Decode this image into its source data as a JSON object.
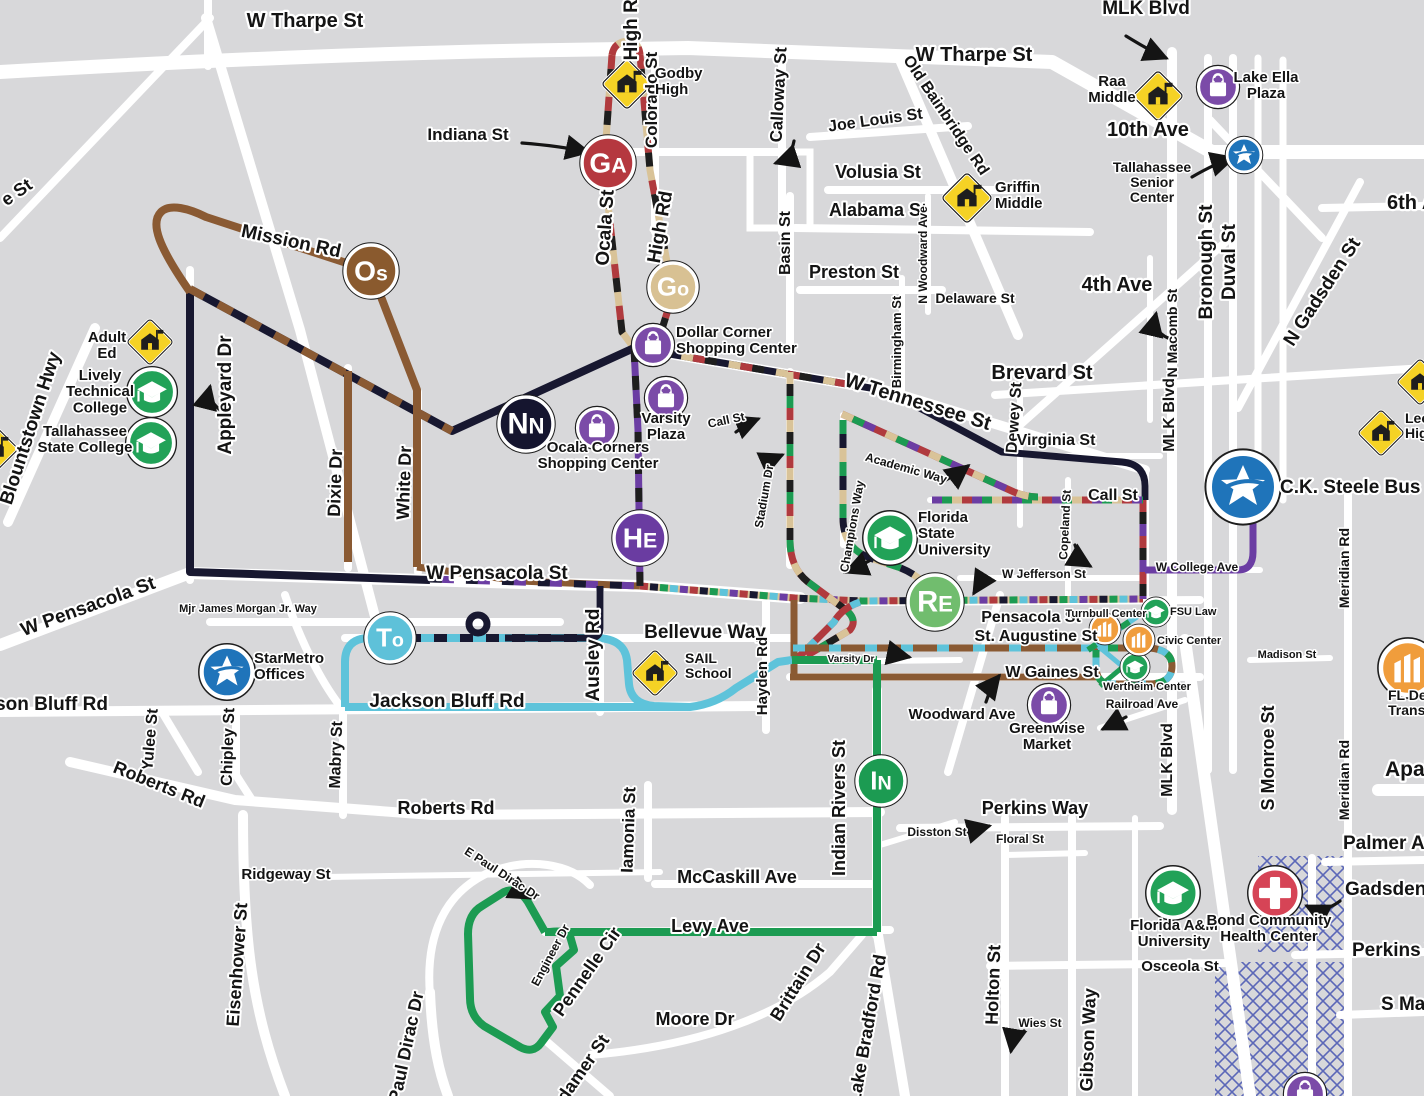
{
  "palette": {
    "background": "#d8d8da",
    "road": "#ffffff",
    "label": "#141414",
    "halo": "#ffffff",
    "ink": "#1e1e1e",
    "navy": "#181830",
    "brown": "#8a5a33",
    "tan": "#d9c398",
    "red": "#b03a3e",
    "purple": "#6b3da3",
    "cyan": "#5ec3da",
    "green": "#1c9b52",
    "light_green": "#72bd72",
    "marker_tan": "#d8c193",
    "school_yellow": "#f5d225",
    "poi_green": "#22a258",
    "poi_purple": "#7b4ba8",
    "poi_blue": "#1f74ba",
    "poi_orange": "#f09d3c",
    "poi_red": "#d64456",
    "hatch": "#5b67b8"
  },
  "route_markers": [
    {
      "id": "ga",
      "label": "GA",
      "x": 608,
      "y": 163,
      "r": 26,
      "color": "#b5383f"
    },
    {
      "id": "go",
      "label": "Go",
      "x": 673,
      "y": 287,
      "r": 24,
      "color": "#d8c193"
    },
    {
      "id": "os",
      "label": "Os",
      "x": 371,
      "y": 271,
      "r": 26,
      "color": "#8a5a2e"
    },
    {
      "id": "nn",
      "label": "NN",
      "x": 526,
      "y": 424,
      "r": 27,
      "color": "#15152f"
    },
    {
      "id": "he",
      "label": "HE",
      "x": 640,
      "y": 538,
      "r": 26,
      "color": "#6a3ca1"
    },
    {
      "id": "to",
      "label": "To",
      "x": 390,
      "y": 638,
      "r": 24,
      "color": "#5ec1d9"
    },
    {
      "id": "re",
      "label": "RE",
      "x": 935,
      "y": 602,
      "r": 27,
      "color": "#71bd6e"
    },
    {
      "id": "in",
      "label": "IN",
      "x": 881,
      "y": 781,
      "r": 24,
      "color": "#1c9b52"
    }
  ],
  "labels": [
    {
      "t": "W Tharpe St",
      "x": 305,
      "y": 27,
      "s": 20
    },
    {
      "t": "W Tharpe St",
      "x": 974,
      "y": 61,
      "s": 20
    },
    {
      "t": "MLK Blvd",
      "x": 1146,
      "y": 14,
      "s": 19
    },
    {
      "t": "High Rd",
      "x": 637,
      "y": 24,
      "r": -90,
      "s": 19
    },
    {
      "t": "Ocala St",
      "x": 611,
      "y": 228,
      "r": -86,
      "s": 19
    },
    {
      "t": "High Rd",
      "x": 666,
      "y": 228,
      "r": -80,
      "s": 19
    },
    {
      "t": "Indiana St",
      "x": 468,
      "y": 140,
      "s": 17
    },
    {
      "t": "Colorado St",
      "x": 657,
      "y": 100,
      "r": -90,
      "s": 17
    },
    {
      "t": "Calloway St",
      "x": 784,
      "y": 95,
      "r": -87,
      "s": 17
    },
    {
      "t": "Joe Louis St",
      "x": 876,
      "y": 125,
      "r": -8,
      "s": 16
    },
    {
      "t": "Old Bainbridge Rd",
      "x": 942,
      "y": 118,
      "r": 56,
      "s": 16
    },
    {
      "t": "Volusia St",
      "x": 878,
      "y": 178,
      "s": 18
    },
    {
      "t": "Alabama St",
      "x": 878,
      "y": 216,
      "s": 18
    },
    {
      "t": "Basin St",
      "x": 790,
      "y": 243,
      "r": -90,
      "s": 16
    },
    {
      "t": "Preston St",
      "x": 854,
      "y": 278,
      "s": 18
    },
    {
      "t": "Delaware St",
      "x": 975,
      "y": 303,
      "s": 14
    },
    {
      "t": "Birmingham St",
      "x": 901,
      "y": 342,
      "r": -90,
      "s": 13
    },
    {
      "t": "N Woodward Ave",
      "x": 927,
      "y": 255,
      "r": -90,
      "s": 12
    },
    {
      "t": "4th Ave",
      "x": 1117,
      "y": 291,
      "s": 20
    },
    {
      "t": "N Macomb St",
      "x": 1177,
      "y": 333,
      "r": -90,
      "s": 14
    },
    {
      "t": "Bronough St",
      "x": 1212,
      "y": 262,
      "r": -90,
      "s": 19
    },
    {
      "t": "Duval St",
      "x": 1235,
      "y": 262,
      "r": -90,
      "s": 19
    },
    {
      "t": "N Gadsden St",
      "x": 1327,
      "y": 295,
      "r": -57,
      "s": 19
    },
    {
      "t": "6th Ave",
      "x": 1387,
      "y": 209,
      "s": 20,
      "a": "start"
    },
    {
      "t": "10th Ave",
      "x": 1148,
      "y": 136,
      "s": 20
    },
    {
      "t": "e St",
      "x": 20,
      "y": 197,
      "r": -35,
      "s": 18
    },
    {
      "t": "Mission Rd",
      "x": 290,
      "y": 247,
      "r": 12,
      "s": 19
    },
    {
      "t": "Blountstown Hwy",
      "x": 36,
      "y": 430,
      "r": -72,
      "s": 19
    },
    {
      "t": "Appleyard Dr",
      "x": 231,
      "y": 395,
      "r": -90,
      "s": 19
    },
    {
      "t": "Dixie Dr",
      "x": 341,
      "y": 483,
      "r": -88,
      "s": 18
    },
    {
      "t": "White Dr",
      "x": 410,
      "y": 483,
      "r": -88,
      "s": 18
    },
    {
      "t": "W Tennessee St",
      "x": 916,
      "y": 408,
      "r": 17,
      "s": 20
    },
    {
      "t": "Call St",
      "x": 727,
      "y": 424,
      "r": -12,
      "s": 12
    },
    {
      "t": "Academic Way",
      "x": 905,
      "y": 472,
      "r": 16,
      "s": 12
    },
    {
      "t": "Call St",
      "x": 1113,
      "y": 500,
      "s": 16
    },
    {
      "t": "Brevard St",
      "x": 1042,
      "y": 379,
      "s": 20
    },
    {
      "t": "Dewey St",
      "x": 1019,
      "y": 418,
      "r": -86,
      "s": 16
    },
    {
      "t": "Virginia St",
      "x": 1056,
      "y": 445,
      "s": 16
    },
    {
      "t": "MLK Blvd",
      "x": 1174,
      "y": 415,
      "r": -90,
      "s": 16
    },
    {
      "t": "MLK Blvd",
      "x": 1172,
      "y": 760,
      "r": -90,
      "s": 16
    },
    {
      "t": "Copeland St",
      "x": 1069,
      "y": 525,
      "r": -87,
      "s": 12
    },
    {
      "t": "Champions Way",
      "x": 856,
      "y": 527,
      "r": -80,
      "s": 12
    },
    {
      "t": "Stadium Dr",
      "x": 768,
      "y": 497,
      "r": -80,
      "s": 12
    },
    {
      "t": "W Jefferson St",
      "x": 1002,
      "y": 578,
      "s": 12,
      "a": "start"
    },
    {
      "t": "W College Ave",
      "x": 1197,
      "y": 571,
      "s": 12
    },
    {
      "t": "Meridian Rd",
      "x": 1349,
      "y": 568,
      "r": -90,
      "s": 14
    },
    {
      "t": "Meridian Rd",
      "x": 1349,
      "y": 780,
      "r": -90,
      "s": 14
    },
    {
      "t": "Pensacola St",
      "x": 1031,
      "y": 622,
      "s": 16
    },
    {
      "t": "St. Augustine St",
      "x": 1036,
      "y": 641,
      "s": 16
    },
    {
      "t": "Madison St",
      "x": 1287,
      "y": 658,
      "s": 11
    },
    {
      "t": "W Gaines St",
      "x": 1052,
      "y": 677,
      "s": 16
    },
    {
      "t": "Railroad Ave",
      "x": 1142,
      "y": 708,
      "s": 12
    },
    {
      "t": "Varsity Dr",
      "x": 851,
      "y": 662,
      "s": 10
    },
    {
      "t": "Woodward Ave",
      "x": 962,
      "y": 719,
      "s": 15
    },
    {
      "t": "Mjr James Morgan Jr. Way",
      "x": 248,
      "y": 612,
      "s": 11
    },
    {
      "t": "W Pensacola St",
      "x": 90,
      "y": 612,
      "r": -20,
      "s": 19
    },
    {
      "t": "W Pensacola St",
      "x": 497,
      "y": 579,
      "s": 19
    },
    {
      "t": "Ausley Rd",
      "x": 599,
      "y": 655,
      "r": -90,
      "s": 19
    },
    {
      "t": "Bellevue Way",
      "x": 705,
      "y": 638,
      "s": 19
    },
    {
      "t": "Hayden Rd",
      "x": 767,
      "y": 676,
      "r": -90,
      "s": 15
    },
    {
      "t": "Jackson Bluff Rd",
      "x": 447,
      "y": 707,
      "s": 19
    },
    {
      "t": "Jackson Bluff Rd",
      "x": 108,
      "y": 710,
      "s": 19,
      "a": "end"
    },
    {
      "t": "Yulee St",
      "x": 155,
      "y": 740,
      "r": -85,
      "s": 16
    },
    {
      "t": "Chipley St",
      "x": 233,
      "y": 747,
      "r": -88,
      "s": 16
    },
    {
      "t": "Mabry St",
      "x": 341,
      "y": 755,
      "r": -88,
      "s": 16
    },
    {
      "t": "Roberts Rd",
      "x": 157,
      "y": 790,
      "r": 22,
      "s": 18
    },
    {
      "t": "Roberts Rd",
      "x": 446,
      "y": 814,
      "s": 18
    },
    {
      "t": "Ridgeway St",
      "x": 286,
      "y": 879,
      "s": 15
    },
    {
      "t": "Eisenhower St",
      "x": 243,
      "y": 965,
      "r": -86,
      "s": 18
    },
    {
      "t": "Paul Dirac Dr",
      "x": 412,
      "y": 1048,
      "r": -78,
      "s": 18
    },
    {
      "t": "E Paul Dirac Dr",
      "x": 500,
      "y": 877,
      "r": 33,
      "s": 12
    },
    {
      "t": "Engineer Dr",
      "x": 554,
      "y": 957,
      "r": -62,
      "s": 12
    },
    {
      "t": "Pennelle Cir",
      "x": 592,
      "y": 975,
      "r": -55,
      "s": 18
    },
    {
      "t": "Iamonia St",
      "x": 634,
      "y": 830,
      "r": -88,
      "s": 17
    },
    {
      "t": "McCaskill Ave",
      "x": 737,
      "y": 883,
      "s": 18
    },
    {
      "t": "Levy Ave",
      "x": 710,
      "y": 932,
      "s": 18
    },
    {
      "t": "Moore Dr",
      "x": 695,
      "y": 1025,
      "s": 18
    },
    {
      "t": "Brittain Dr",
      "x": 803,
      "y": 985,
      "r": -58,
      "s": 18
    },
    {
      "t": "Lake Bradford Rd",
      "x": 873,
      "y": 1030,
      "r": -80,
      "s": 18
    },
    {
      "t": "Pottsdamer St",
      "x": 575,
      "y": 1090,
      "r": -55,
      "s": 18
    },
    {
      "t": "Indian Rivers St",
      "x": 845,
      "y": 808,
      "r": -90,
      "s": 18
    },
    {
      "t": "Perkins Way",
      "x": 1035,
      "y": 814,
      "s": 18
    },
    {
      "t": "Disston St",
      "x": 937,
      "y": 836,
      "s": 12
    },
    {
      "t": "Floral St",
      "x": 1020,
      "y": 843,
      "s": 12
    },
    {
      "t": "Holton St",
      "x": 999,
      "y": 985,
      "r": -88,
      "s": 18
    },
    {
      "t": "Wies St",
      "x": 1040,
      "y": 1027,
      "s": 12
    },
    {
      "t": "Gibson Way",
      "x": 1094,
      "y": 1040,
      "r": -88,
      "s": 18
    },
    {
      "t": "Osceola St",
      "x": 1180,
      "y": 971,
      "s": 15
    },
    {
      "t": "S Monroe St",
      "x": 1274,
      "y": 758,
      "r": -90,
      "s": 18
    },
    {
      "t": "Palmer Ave",
      "x": 1343,
      "y": 849,
      "s": 19,
      "a": "start"
    },
    {
      "t": "Gadsden St",
      "x": 1345,
      "y": 895,
      "s": 19,
      "a": "start"
    },
    {
      "t": "Perkins Way",
      "x": 1352,
      "y": 956,
      "s": 19,
      "a": "start"
    },
    {
      "t": "S Magnolia Dr",
      "x": 1381,
      "y": 1010,
      "s": 19,
      "a": "start"
    },
    {
      "t": "Apalachee Pkwy",
      "x": 1385,
      "y": 776,
      "s": 21,
      "a": "start"
    },
    {
      "n": "poi-label",
      "t": "Godby High",
      "x": 655,
      "y": 78,
      "s": 15,
      "a": "start",
      "lines": [
        "Godby",
        "High"
      ]
    },
    {
      "n": "poi-label",
      "t": "Raa Middle",
      "x": 1112,
      "y": 86,
      "s": 15,
      "lines": [
        "Raa",
        "Middle"
      ]
    },
    {
      "n": "poi-label",
      "t": "Lake Ella Plaza",
      "x": 1266,
      "y": 82,
      "s": 15,
      "lines": [
        "Lake Ella",
        "Plaza"
      ]
    },
    {
      "n": "poi-label",
      "t": "Griffin Middle",
      "x": 995,
      "y": 192,
      "s": 15,
      "a": "start",
      "lines": [
        "Griffin",
        "Middle"
      ]
    },
    {
      "n": "poi-label",
      "t": "Tallahassee Senior Center",
      "x": 1152,
      "y": 172,
      "s": 14,
      "lines": [
        "Tallahassee",
        "Senior",
        "Center"
      ]
    },
    {
      "n": "poi-label",
      "t": "Adult Ed",
      "x": 107,
      "y": 342,
      "s": 15,
      "lines": [
        "Adult",
        "Ed"
      ]
    },
    {
      "n": "poi-label",
      "t": "Lively Technical College",
      "x": 100,
      "y": 380,
      "s": 15,
      "lines": [
        "Lively",
        "Technical",
        "College"
      ]
    },
    {
      "n": "poi-label",
      "t": "Tallahassee State College",
      "x": 85,
      "y": 436,
      "s": 15,
      "lines": [
        "Tallahassee",
        "State College"
      ]
    },
    {
      "n": "poi-label",
      "t": "Dollar Corner Shopping Center",
      "x": 676,
      "y": 337,
      "s": 15,
      "a": "start",
      "lines": [
        "Dollar Corner",
        "Shopping Center"
      ]
    },
    {
      "n": "poi-label",
      "t": "Varsity Plaza",
      "x": 666,
      "y": 423,
      "s": 15,
      "lines": [
        "Varsity",
        "Plaza"
      ]
    },
    {
      "n": "poi-label",
      "t": "Ocala Corners Shopping Center",
      "x": 598,
      "y": 452,
      "s": 15,
      "lines": [
        "Ocala Corners",
        "Shopping Center"
      ]
    },
    {
      "n": "poi-label",
      "t": "Florida State University",
      "x": 918,
      "y": 522,
      "s": 15,
      "a": "start",
      "lines": [
        "Florida",
        "State",
        "University"
      ]
    },
    {
      "n": "poi-label",
      "t": "C.K. Steele Bus Plaza",
      "x": 1280,
      "y": 493,
      "s": 19,
      "a": "start"
    },
    {
      "n": "poi-label",
      "t": "Leon High",
      "x": 1405,
      "y": 423,
      "s": 14,
      "a": "start",
      "lines": [
        "Leon",
        "High"
      ]
    },
    {
      "n": "poi-label",
      "t": "Turnbull Center",
      "x": 1106,
      "y": 617,
      "s": 11
    },
    {
      "n": "poi-label",
      "t": "FSU Law",
      "x": 1170,
      "y": 615,
      "s": 11,
      "a": "start"
    },
    {
      "n": "poi-label",
      "t": "Civic Center",
      "x": 1157,
      "y": 644,
      "s": 11,
      "a": "start"
    },
    {
      "n": "poi-label",
      "t": "Wertheim Center",
      "x": 1147,
      "y": 690,
      "s": 11
    },
    {
      "n": "poi-label",
      "t": "StarMetro Offices",
      "x": 254,
      "y": 663,
      "s": 15,
      "a": "start",
      "lines": [
        "StarMetro",
        "Offices"
      ]
    },
    {
      "n": "poi-label",
      "t": "SAIL School",
      "x": 685,
      "y": 663,
      "s": 14,
      "a": "start",
      "lines": [
        "SAIL",
        "School"
      ]
    },
    {
      "n": "poi-label",
      "t": "Greenwise Market",
      "x": 1047,
      "y": 733,
      "s": 15,
      "lines": [
        "Greenwise",
        "Market"
      ]
    },
    {
      "n": "poi-label",
      "t": "Florida A&M University",
      "x": 1174,
      "y": 930,
      "s": 15,
      "lines": [
        "Florida A&M",
        "University"
      ]
    },
    {
      "n": "poi-label",
      "t": "Bond Community Health Center",
      "x": 1269,
      "y": 925,
      "s": 15,
      "lines": [
        "Bond Community",
        "Health Center"
      ]
    },
    {
      "n": "poi-label",
      "t": "FL Dept of Transportation",
      "x": 1388,
      "y": 700,
      "s": 14,
      "a": "start",
      "lines": [
        "FL Dept of",
        "Transportation"
      ]
    }
  ],
  "pois": [
    {
      "type": "school",
      "name": "godby-high-school-icon",
      "x": 627,
      "y": 84,
      "s": 1.2
    },
    {
      "type": "school",
      "name": "griffin-middle-school-icon",
      "x": 967,
      "y": 198,
      "s": 1.2
    },
    {
      "type": "school",
      "name": "raa-middle-school-icon",
      "x": 1158,
      "y": 96,
      "s": 1.2
    },
    {
      "type": "school",
      "name": "adult-ed-school-icon",
      "x": 150,
      "y": 342,
      "s": 1.1
    },
    {
      "type": "school",
      "name": "sail-school-icon",
      "x": 655,
      "y": 673,
      "s": 1.1
    },
    {
      "type": "school",
      "name": "leon-high-school-icon",
      "x": 1381,
      "y": 433,
      "s": 1.1
    },
    {
      "type": "school",
      "name": "school-icon-edge",
      "x": 1420,
      "y": 382,
      "s": 1.1
    },
    {
      "type": "school",
      "name": "school-icon-edge-left",
      "x": -5,
      "y": 449,
      "s": 1.1
    },
    {
      "type": "grad",
      "name": "lively-technical-college-icon",
      "x": 152,
      "y": 392,
      "s": 1.35
    },
    {
      "type": "grad",
      "name": "tallahassee-state-college-icon",
      "x": 151,
      "y": 443,
      "s": 1.35
    },
    {
      "type": "grad",
      "name": "florida-state-university-icon",
      "x": 890,
      "y": 538,
      "s": 1.45
    },
    {
      "type": "grad",
      "name": "florida-am-university-icon",
      "x": 1173,
      "y": 893,
      "s": 1.45
    },
    {
      "type": "grad",
      "name": "fsu-law-icon",
      "x": 1156,
      "y": 612,
      "s": 0.8
    },
    {
      "type": "grad",
      "name": "wertheim-center-icon",
      "x": 1135,
      "y": 667,
      "s": 0.8
    },
    {
      "type": "bag",
      "name": "lake-ella-plaza-icon",
      "x": 1218,
      "y": 87,
      "s": 1.15
    },
    {
      "type": "bag",
      "name": "dollar-corner-icon",
      "x": 653,
      "y": 345,
      "s": 1.15
    },
    {
      "type": "bag",
      "name": "varsity-plaza-icon",
      "x": 666,
      "y": 398,
      "s": 1.15
    },
    {
      "type": "bag",
      "name": "ocala-corners-icon",
      "x": 597,
      "y": 428,
      "s": 1.15
    },
    {
      "type": "bag",
      "name": "greenwise-market-icon",
      "x": 1049,
      "y": 705,
      "s": 1.15
    },
    {
      "type": "bag",
      "name": "bag-icon-edge-bottom",
      "x": 1305,
      "y": 1094,
      "s": 1.15
    },
    {
      "type": "star",
      "name": "tallahassee-senior-center-icon",
      "x": 1244,
      "y": 155,
      "s": 1.0
    },
    {
      "type": "star",
      "name": "starmetro-offices-icon",
      "x": 227,
      "y": 672,
      "s": 1.5
    },
    {
      "type": "star",
      "name": "ck-steele-bus-plaza-icon",
      "x": 1243,
      "y": 487,
      "s": 2.0
    },
    {
      "type": "bldg",
      "name": "turnbull-center-icon",
      "x": 1105,
      "y": 629,
      "s": 0.85
    },
    {
      "type": "bldg",
      "name": "civic-center-icon",
      "x": 1139,
      "y": 640,
      "s": 0.85
    },
    {
      "type": "bldg",
      "name": "fl-dept-transportation-icon",
      "x": 1408,
      "y": 668,
      "s": 1.6
    },
    {
      "type": "cross",
      "name": "bond-community-health-center-icon",
      "x": 1275,
      "y": 893,
      "s": 1.45
    }
  ]
}
